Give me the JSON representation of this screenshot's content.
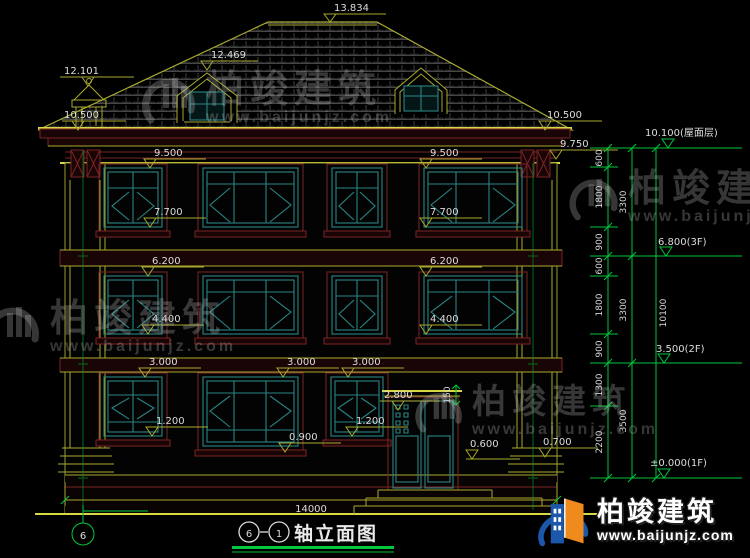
{
  "colors": {
    "background": "#000000",
    "line_yellow": "#a9a92f",
    "line_maroon": "#7a2424",
    "window_teal": "#2a8585",
    "dim_green": "#00c83c",
    "text_white": "#dcdcdc",
    "logo_blue": "#1b58aa",
    "logo_orange": "#ef8b1d"
  },
  "marks": {
    "ridge": "13.834",
    "dormer_left": "12.469",
    "chimney": "12.101",
    "eave_left": "10.500",
    "eave_right": "10.500",
    "cornice_right": "9.750",
    "f3_top_left": "9.500",
    "f3_top_right": "9.500",
    "f3_sill_left": "7.700",
    "f3_sill_right": "7.700",
    "f2_top_left": "6.200",
    "f2_top_right": "6.200",
    "f2_sill_left": "4.400",
    "f2_sill_right": "4.400",
    "f1_top_a": "3.000",
    "f1_top_b": "3.000",
    "f1_top_c": "3.000",
    "f1_sill_a": "1.200",
    "f1_sill_b": "1.200",
    "sill_low": "0.900",
    "door_head": "2.800",
    "door_dim": "150",
    "porch": "0.600",
    "plinth": "0.700"
  },
  "dimensions": {
    "total_width": "14000",
    "right_chain_segments": [
      "600",
      "1800",
      "900",
      "600",
      "1800",
      "900",
      "1300",
      "2200"
    ],
    "right_chain_floors": [
      "3300",
      "3300",
      "3500"
    ],
    "right_total": "10100",
    "levels": [
      "10.100(屋面层)",
      "6.800(3F)",
      "3.500(2F)",
      "±0.000(1F)"
    ]
  },
  "title_block": {
    "axis_from": "6",
    "axis_to": "1",
    "title": "轴立面图"
  },
  "axis_bubble": "6",
  "watermark": {
    "brand": "柏竣建筑",
    "url": "www.baijunjz.com"
  },
  "brand_logo": {
    "brand": "柏竣建筑",
    "url": "www.baijunjz.com"
  }
}
